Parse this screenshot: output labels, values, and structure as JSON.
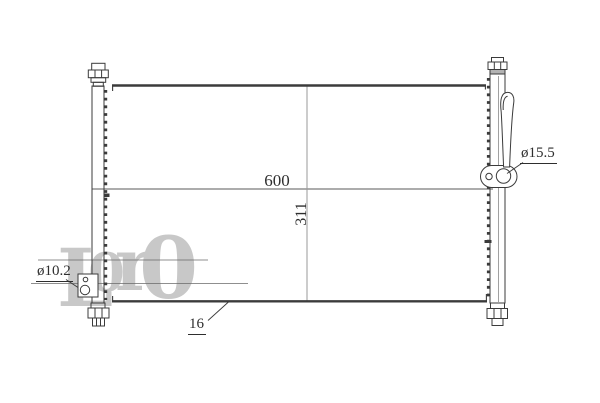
{
  "drawing": {
    "dimensions": {
      "overall_width_mm": "600",
      "overall_height_mm": "311",
      "right_port_diameter": "ø15.5",
      "left_port_diameter": "ø10.2",
      "core_depth_mm": "16"
    },
    "watermark": {
      "char1": "L",
      "char2": "0",
      "char3": "r",
      "char4": "0"
    },
    "colors": {
      "line": "#3b3b3b",
      "watermark": "#c8c8c8"
    }
  }
}
